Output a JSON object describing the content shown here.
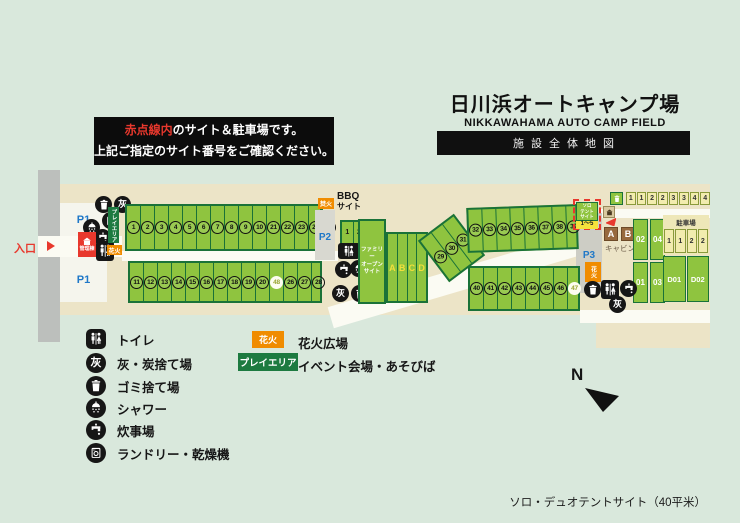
{
  "title": {
    "jp": "日川浜オートキャンプ場",
    "en": "NIKKAWAHAMA AUTO CAMP FIELD",
    "banner": "施設全体地図"
  },
  "notice": {
    "highlight": "赤点線内",
    "line1_rest": "のサイト＆駐車場です。",
    "line2": "上記ご指定のサイト番号をご確認ください。"
  },
  "colors": {
    "site_green": "#8fc43f",
    "site_border": "#1a7238",
    "accent_red": "#e8382d",
    "badge_orange": "#f08c00",
    "badge_green": "#1d7a40",
    "parking_blue": "#1f78c8"
  },
  "map": {
    "entrance_label": "入口",
    "management_label": "管理棟",
    "play_area_label": "プレイエリア",
    "fireworks_label_left": "花火",
    "bonfire_label": "焚火",
    "fireworks_label_right": "花火",
    "p1_upper": "P1",
    "p1_lower": "P1",
    "p2": "P2",
    "p3": "P3",
    "bbq_title_1": "BBQ",
    "bbq_title_2": "サイト",
    "bbq_cells": [
      "1",
      "2",
      "3"
    ],
    "family_label_lines": [
      "ファミリー",
      "オープン",
      "サイト"
    ],
    "family_cells": [
      "A",
      "B",
      "C",
      "D"
    ],
    "sites_top": [
      "1",
      "2",
      "3",
      "4",
      "5",
      "6",
      "7",
      "8",
      "9",
      "10",
      "21",
      "22",
      "23",
      "24",
      "25"
    ],
    "sites_bottom": [
      "11",
      "12",
      "13",
      "14",
      "15",
      "16",
      "17",
      "18",
      "19",
      "20",
      {
        "n": "48",
        "special": true
      },
      "26",
      "27",
      "28"
    ],
    "sites_diagonal": [
      "29",
      "30",
      "31"
    ],
    "sites_right_top": [
      "32",
      "33",
      "34",
      "35",
      "36",
      "37",
      "38",
      "39"
    ],
    "sites_right_bottom": [
      "40",
      "41",
      "42",
      "43",
      "44",
      "45",
      "46",
      {
        "n": "47",
        "special": true
      }
    ],
    "solo_tent": {
      "lines": [
        "ソロ",
        "テント",
        "サイト"
      ],
      "range": "1〜5"
    },
    "cabin": {
      "units": [
        "A",
        "B"
      ],
      "label": "キャビン",
      "parking_cells": [
        "02",
        "04",
        "01",
        "03"
      ]
    },
    "parking_lot": {
      "label": "駐車場",
      "cells": [
        "1",
        "1",
        "2",
        "2"
      ],
      "d_cells": [
        "D01",
        "D02"
      ]
    },
    "top_parking_cells": [
      "1",
      "1",
      "2",
      "2",
      "3",
      "3",
      "4",
      "4"
    ],
    "compass": "N"
  },
  "icons": {
    "ash_glyph": "灰"
  },
  "legend": {
    "items": [
      {
        "icon": "toilet-icon",
        "label": "トイレ"
      },
      {
        "icon": "ash-icon",
        "label": "灰・炭捨て場"
      },
      {
        "icon": "trash-icon",
        "label": "ゴミ捨て場"
      },
      {
        "icon": "shower-icon",
        "label": "シャワー"
      },
      {
        "icon": "faucet-icon",
        "label": "炊事場"
      },
      {
        "icon": "laundry-icon",
        "label": "ランドリー・乾燥機"
      }
    ],
    "areas": [
      {
        "badge": "花火",
        "label": "花火広場"
      },
      {
        "badge": "プレイエリア",
        "label": "イベント会場・あそびば"
      }
    ]
  },
  "footer": {
    "note": "ソロ・デュオテントサイト（40平米）"
  }
}
